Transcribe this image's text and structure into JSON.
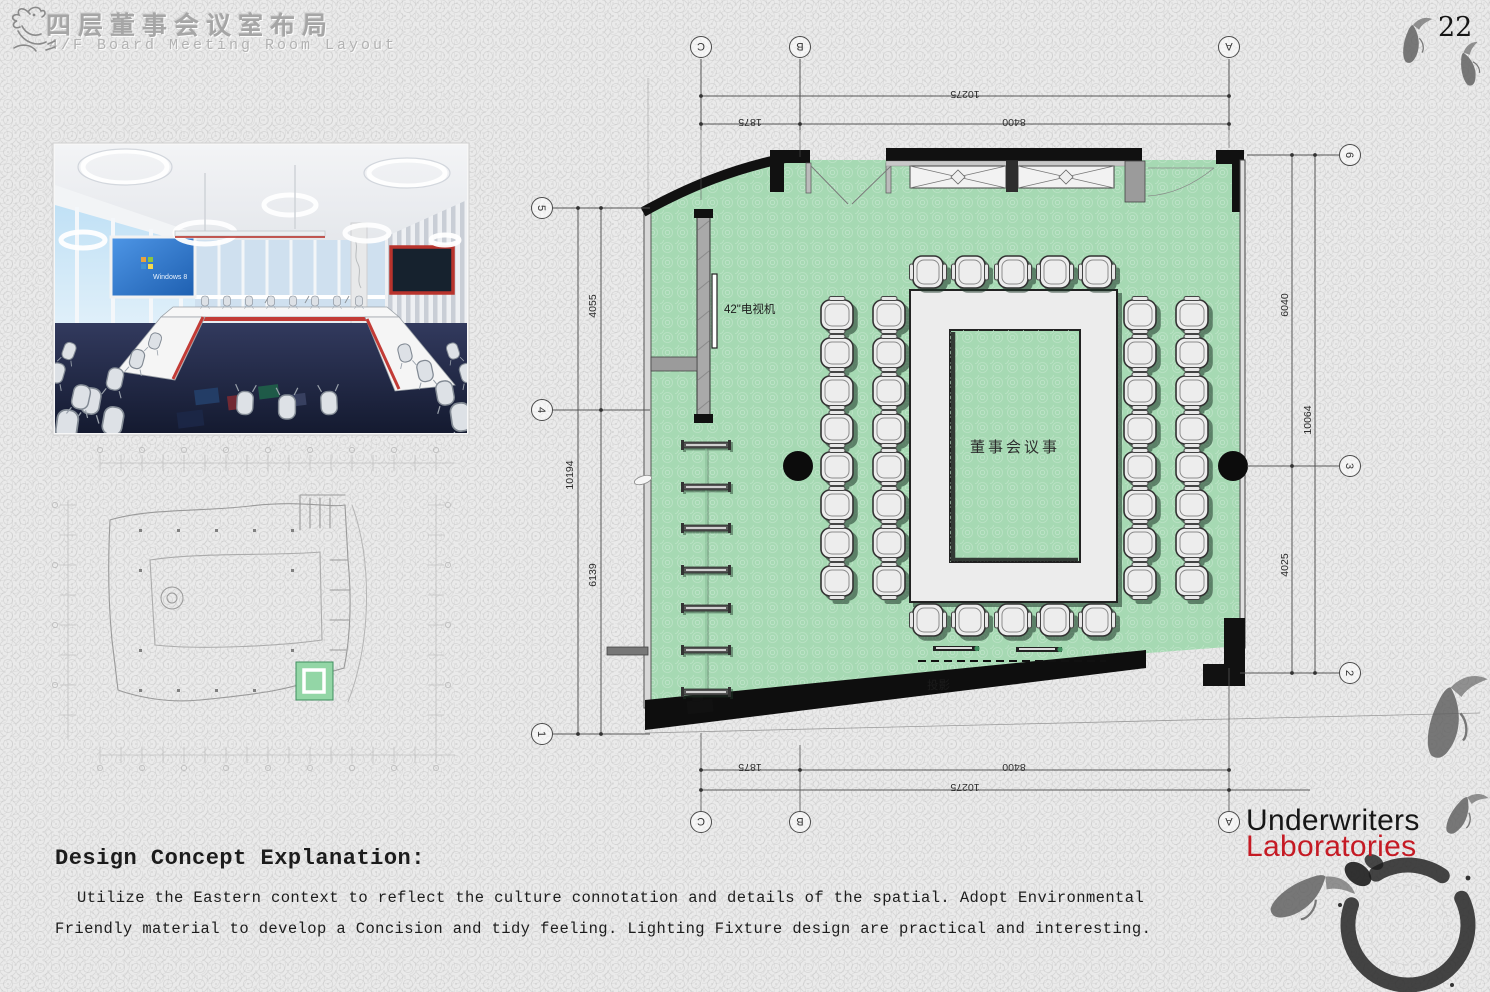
{
  "header": {
    "title_cn": "四层董事会议室布局",
    "title_en": "4/F Board Meeting Room Layout"
  },
  "page": {
    "number": "22"
  },
  "photo": {
    "screen_label": "Windows 8"
  },
  "plan": {
    "room_label": "董事会议事",
    "tv_label": "42\"电视机",
    "projector_label": "投影",
    "grid": {
      "top": [
        "C",
        "B",
        "A"
      ],
      "bottom": [
        "C",
        "B",
        "A"
      ],
      "left": [
        "5",
        "4",
        "1"
      ],
      "right": [
        "6",
        "3",
        "2"
      ]
    },
    "dims": {
      "top_overall": "10275",
      "top_seg_left": "1875",
      "top_seg_right": "8400",
      "bottom_overall": "10275",
      "bottom_seg_left": "1875",
      "bottom_seg_right": "8400",
      "left_overall": "10194",
      "left_seg_top": "4055",
      "left_seg_bottom": "6139",
      "right_overall": "10064",
      "right_seg_top": "6040",
      "right_seg_bottom": "4025"
    }
  },
  "concept": {
    "heading": "Design Concept Explanation:",
    "line1": "Utilize the Eastern context to reflect the culture connotation and details of the spatial.  Adopt Environmental",
    "line2": "Friendly material to develop a Concision and tidy feeling.  Lighting Fixture design are practical and interesting."
  },
  "logo": {
    "line1": "Underwriters",
    "line2": "Laboratories"
  },
  "colors": {
    "floor_green": "#a6d9b3",
    "wall_black": "#111111",
    "logo_red": "#c51a24",
    "carpet_navy": "#232a44"
  }
}
